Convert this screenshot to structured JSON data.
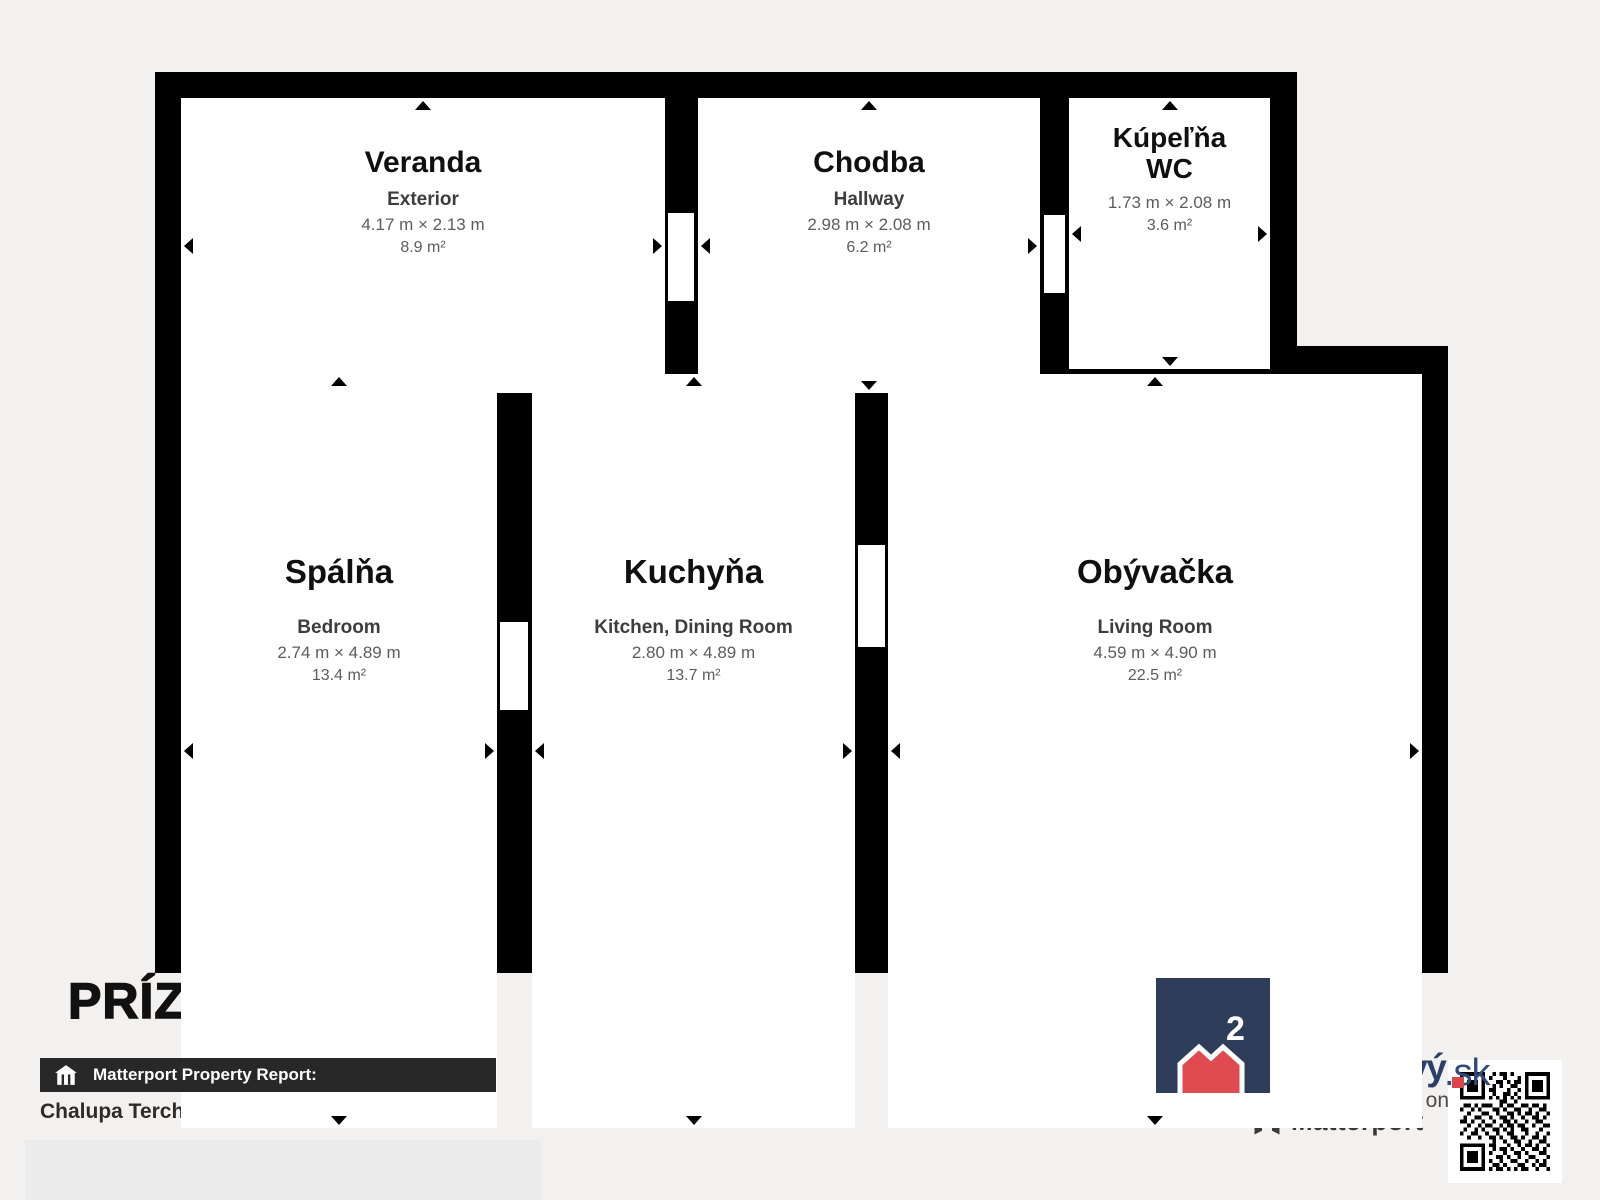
{
  "page": {
    "background": "#f2f1ef",
    "wall_color": "#000000",
    "room_fill": "#ffffff"
  },
  "floorplan": {
    "rooms": [
      {
        "name": "Veranda",
        "subtitle": "Exterior",
        "dimensions": "4.17 m × 2.13 m",
        "area": "8.9 m²"
      },
      {
        "name": "Chodba",
        "subtitle": "Hallway",
        "dimensions": "2.98 m × 2.08 m",
        "area": "6.2 m²"
      },
      {
        "name": "Kúpeľňa WC",
        "subtitle": "",
        "dimensions": "1.73 m × 2.08 m",
        "area": "3.6 m²"
      },
      {
        "name": "Spálňa",
        "subtitle": "Bedroom",
        "dimensions": "2.74 m × 4.89 m",
        "area": "13.4 m²"
      },
      {
        "name": "Kuchyňa",
        "subtitle": "Kitchen, Dining Room",
        "dimensions": "2.80 m × 4.89 m",
        "area": "13.7 m²"
      },
      {
        "name": "Obývačka",
        "subtitle": "Living Room",
        "dimensions": "4.59 m × 4.90 m",
        "area": "22.5 m²"
      }
    ]
  },
  "footer": {
    "floor_title": "PRÍZEMIE",
    "report_bar_label": "Matterport Property Report:",
    "property_name": "Chalupa Terchová"
  },
  "branding": {
    "logo_line1": "meter",
    "logo_line2": "štvorcový",
    "logo_tld": ".sk",
    "logo_superscript": "2",
    "visit_text": "Visit 3D space on",
    "matterport_label": "Matterport",
    "colors": {
      "navy": "#2e3d5a",
      "red": "#df4b51",
      "bar": "#282828"
    }
  }
}
